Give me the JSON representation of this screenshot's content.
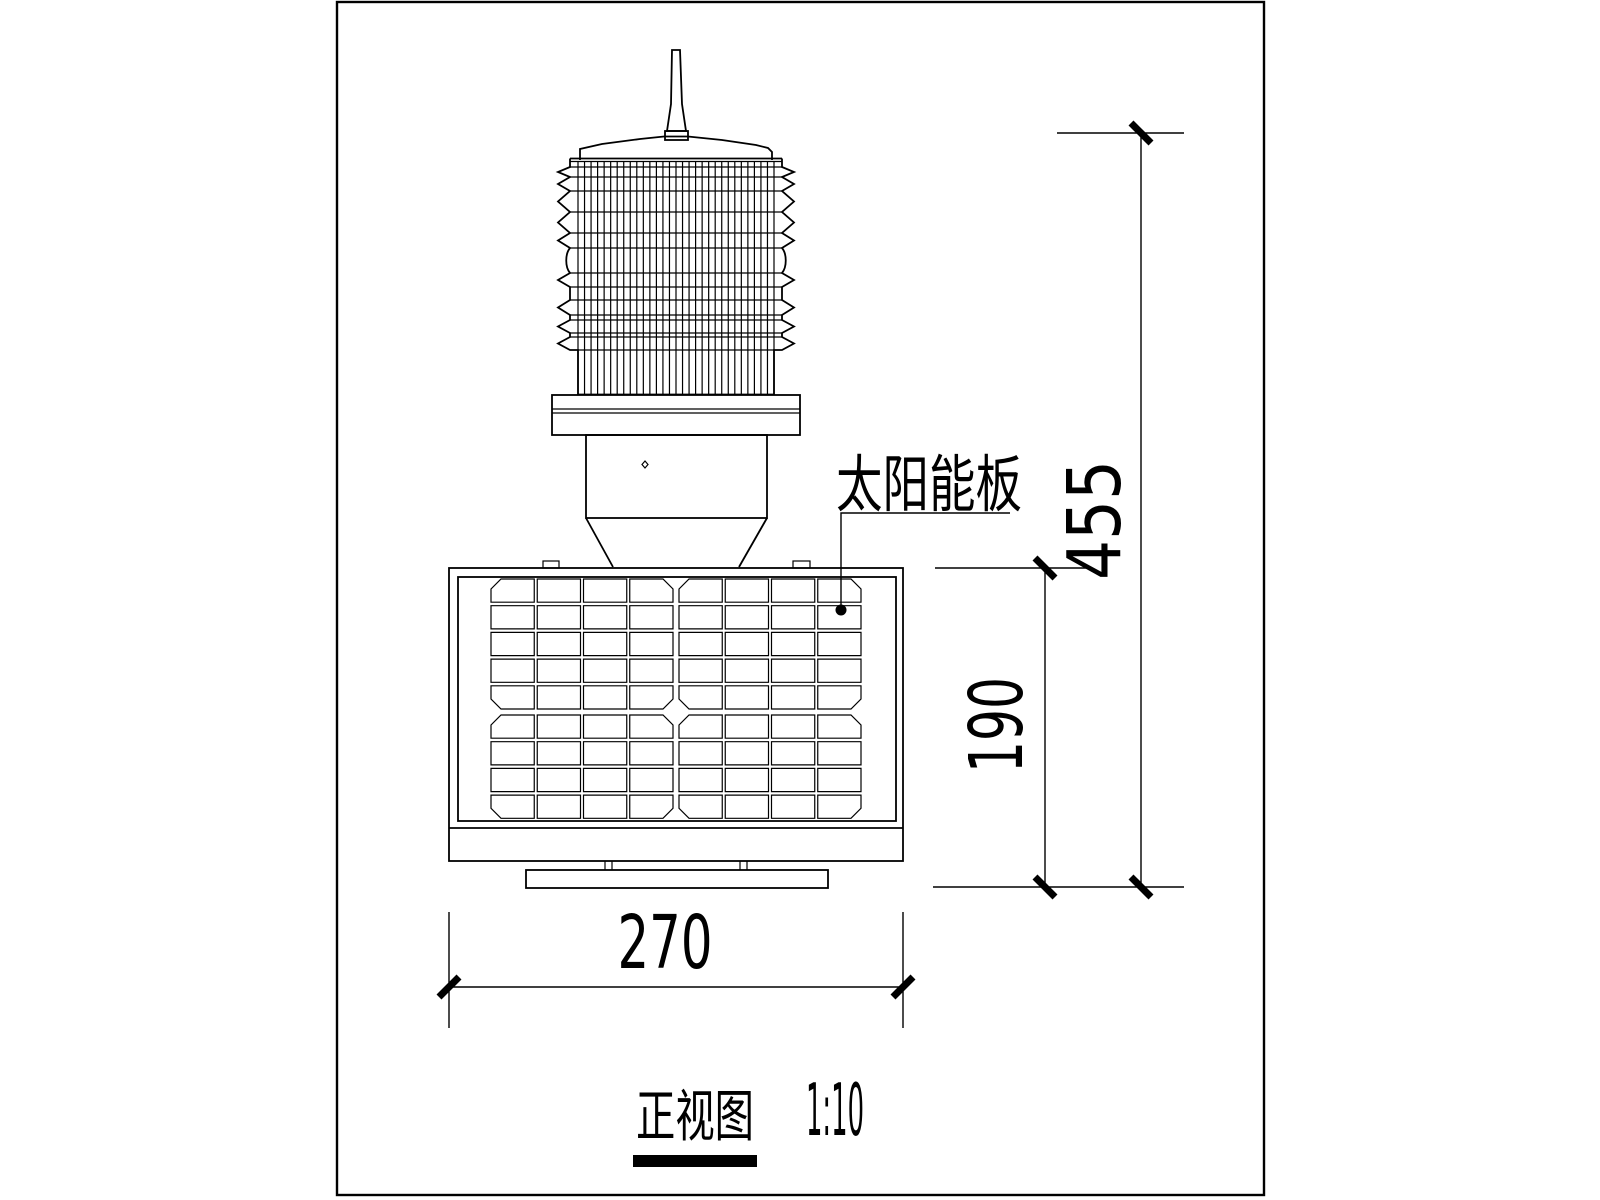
{
  "drawing": {
    "view_title": "正视图",
    "view_scale": "1:10",
    "labels": {
      "solar_panel": "太阳能板"
    },
    "dimensions": {
      "overall_height": "455",
      "panel_height": "190",
      "panel_width": "270"
    },
    "solar_panel_grid": {
      "columns": 8,
      "rows": 9,
      "column_groups": 2
    },
    "colors": {
      "line": "#000000",
      "background": "#ffffff"
    }
  }
}
